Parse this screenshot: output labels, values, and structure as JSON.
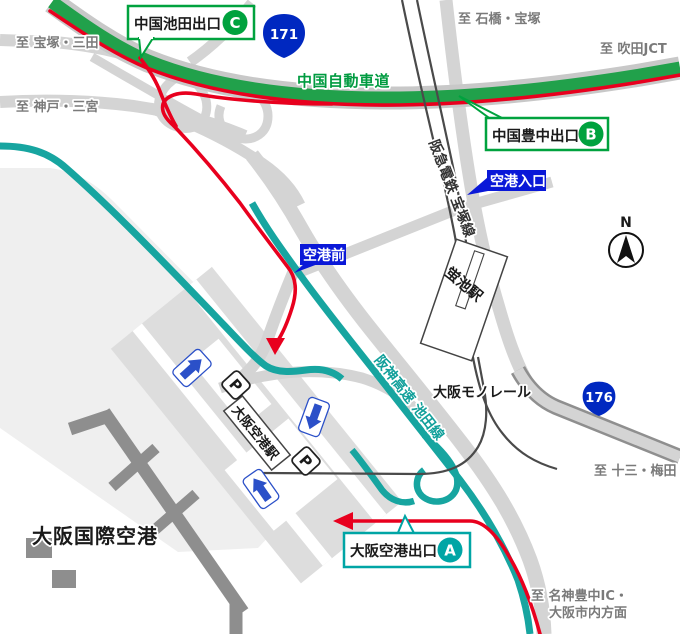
{
  "labels": {
    "to_takarazuka_sanda": "至 宝塚・三田",
    "to_kobe_sannomiya": "至 神戸・三宮",
    "to_ishibashi_takarazuka": "至 石橋・宝塚",
    "to_suita_jct": "至 吹田JCT",
    "to_juso_umeda": "至 十三・梅田",
    "to_meishin_line1": "至 名神豊中IC・",
    "to_meishin_line2": "大阪市内方面",
    "chugoku_expressway": "中国自動車道",
    "hanshin_expressway": "阪神高速 池田線",
    "hankyu_line": "阪急電鉄 宝塚線",
    "monorail": "大阪モノレール",
    "hotarugaike_station": "蛍池駅",
    "osaka_airport_station": "大阪空港駅",
    "airport_name": "大阪国際空港",
    "compass_north": "N",
    "parking": "P"
  },
  "exits": {
    "c": {
      "name": "中国池田出口",
      "letter": "C"
    },
    "b": {
      "name": "中国豊中出口",
      "letter": "B"
    },
    "a": {
      "name": "大阪空港出口",
      "letter": "A"
    }
  },
  "signs": {
    "airport_entrance": "空港入口",
    "airport_front": "空港前"
  },
  "route_shields": {
    "r171": "171",
    "r176": "176"
  },
  "colors": {
    "expressway_green": "#21A14B",
    "green_label": "#009B40",
    "hanshin_teal": "#17A5A0",
    "route_red": "#E8001E",
    "badge_blue": "#0A18D8",
    "shield_blue": "#0028C0",
    "arrow_blue": "#2B50C8",
    "road_gray": "#D4D4D4",
    "building_gray": "#8E8E8E"
  }
}
